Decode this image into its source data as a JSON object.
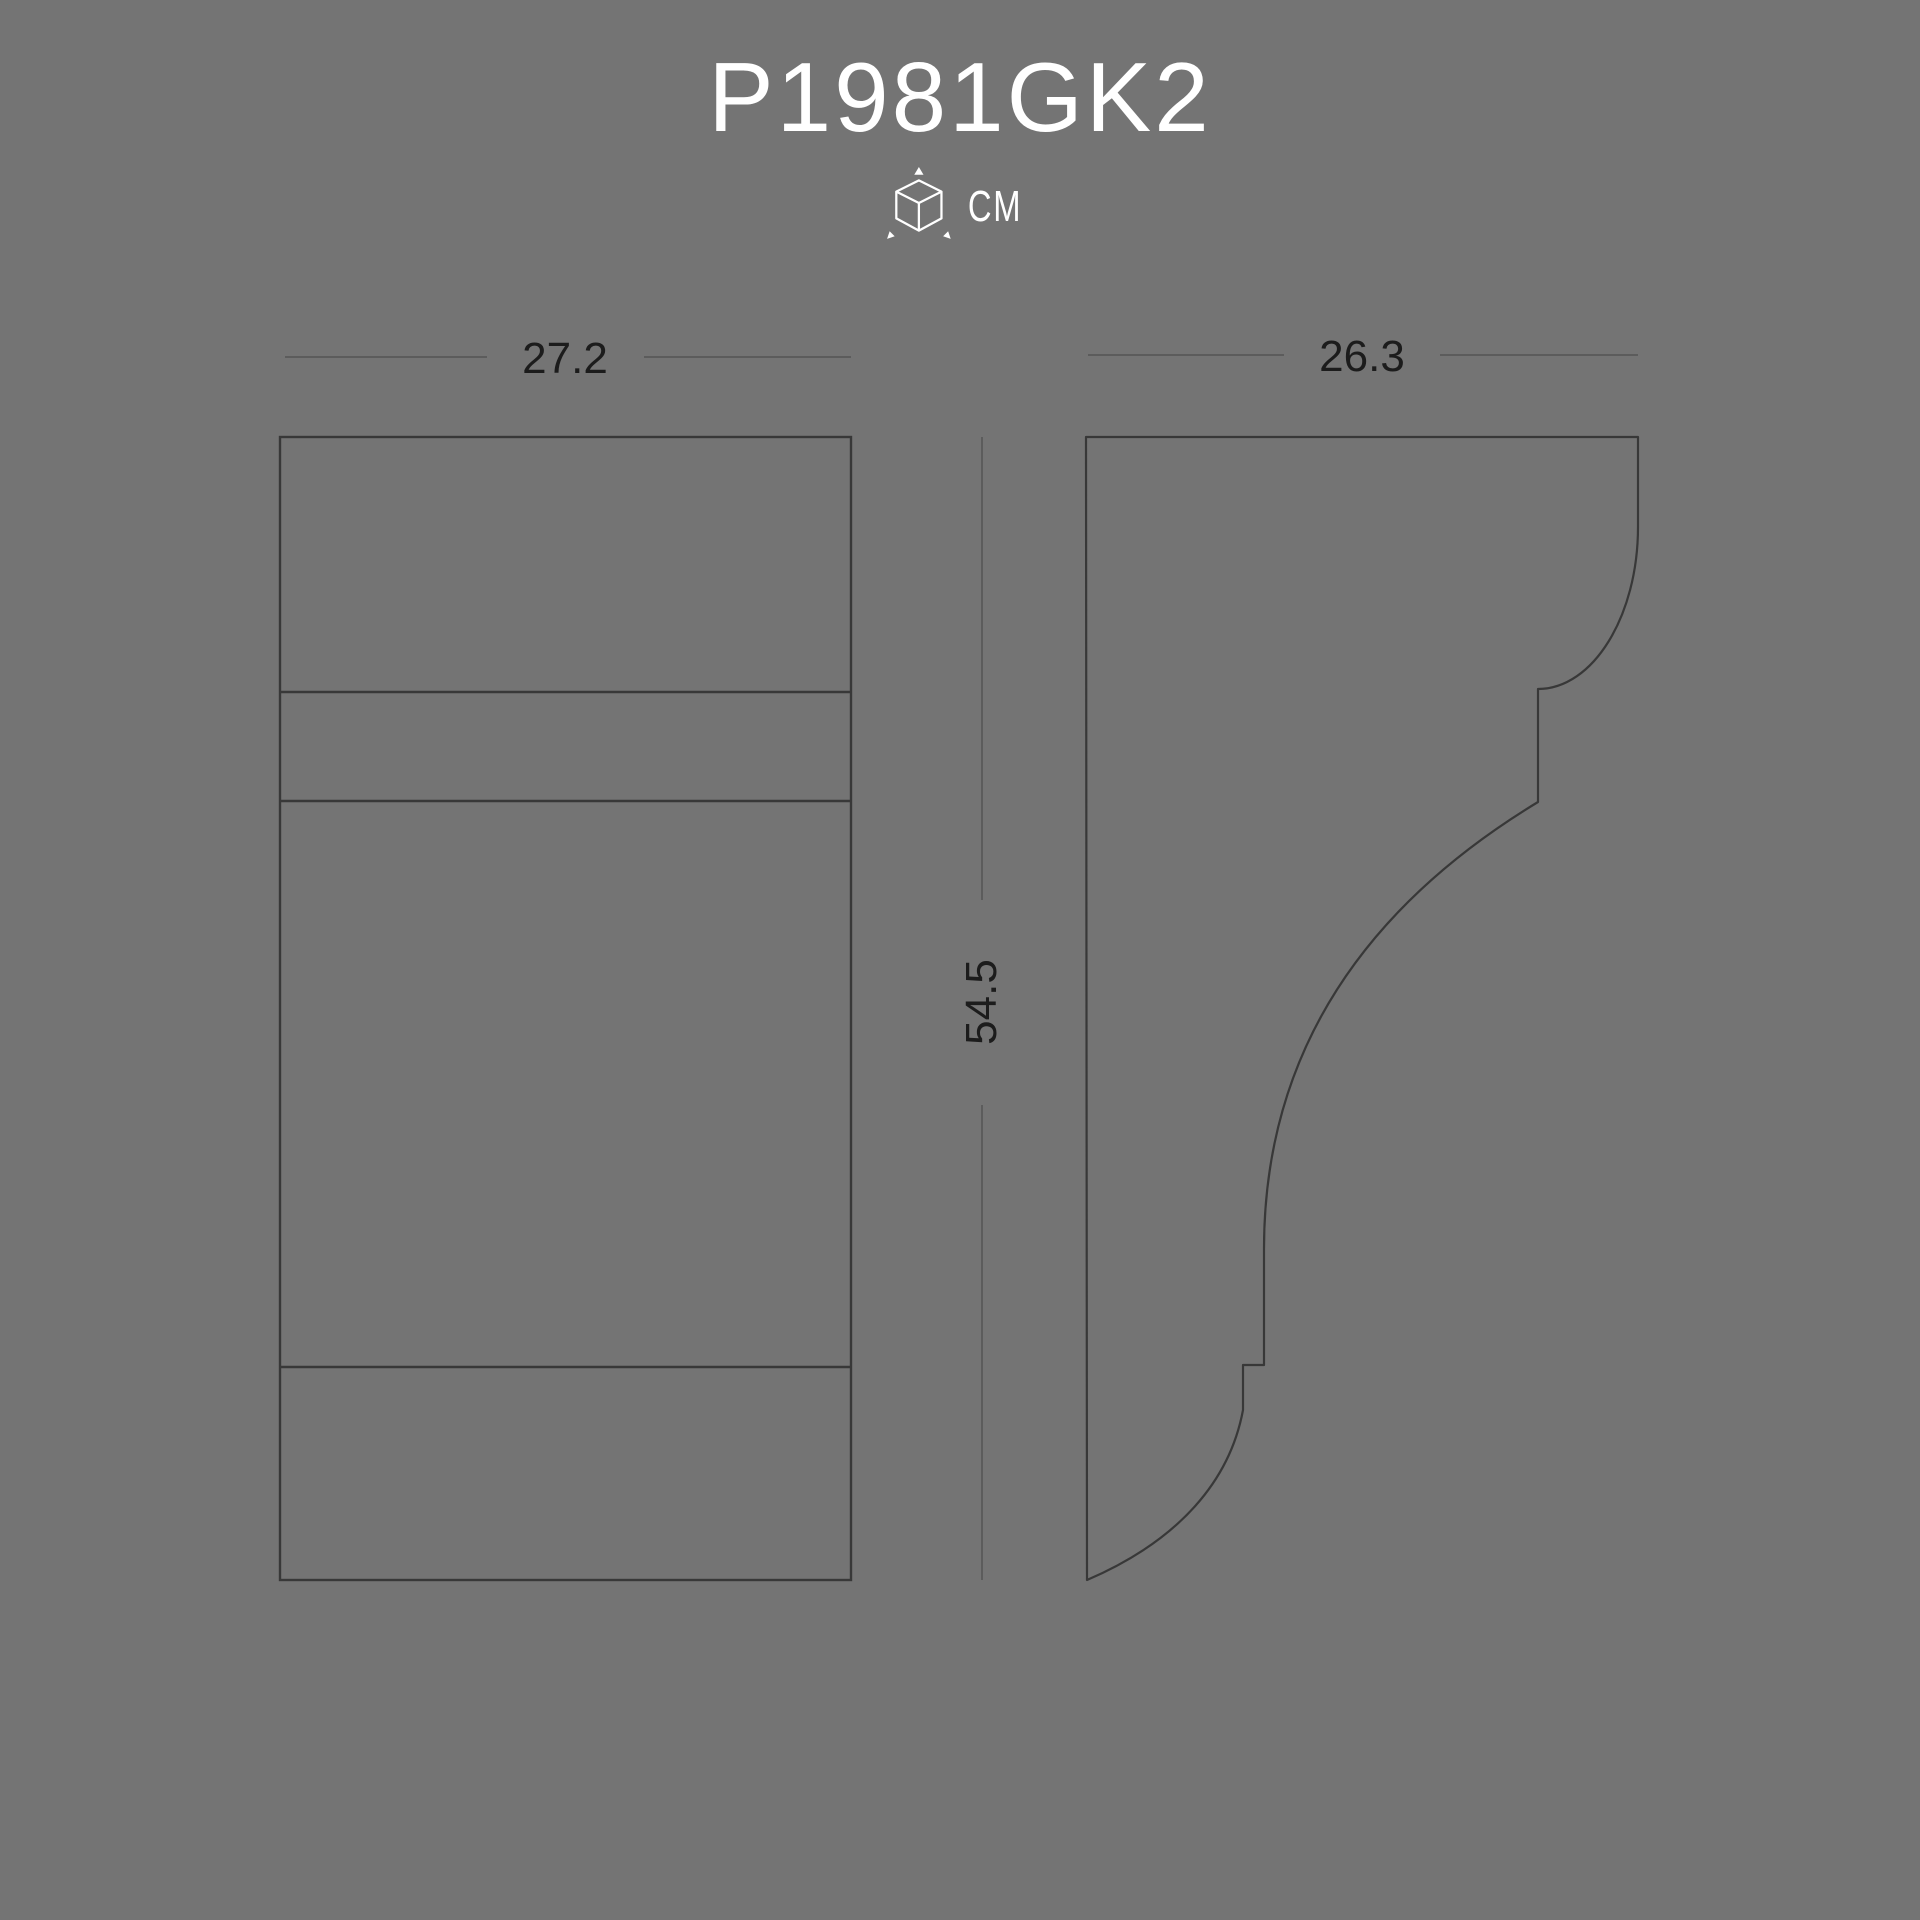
{
  "title": "P1981GK2",
  "unit": {
    "label": "CM",
    "icon": "cube-3d-dimensions-icon"
  },
  "views": {
    "front": {
      "label": "front-view",
      "width": "27.2"
    },
    "side": {
      "label": "side-profile-view",
      "depth": "26.3"
    },
    "height": "54.5"
  },
  "colors": {
    "background": "#747474",
    "drawing_outline": "#383838",
    "dimension_line": "#5c5c5c",
    "dimension_text": "#1c1c1c",
    "title_text": "#ffffff"
  }
}
